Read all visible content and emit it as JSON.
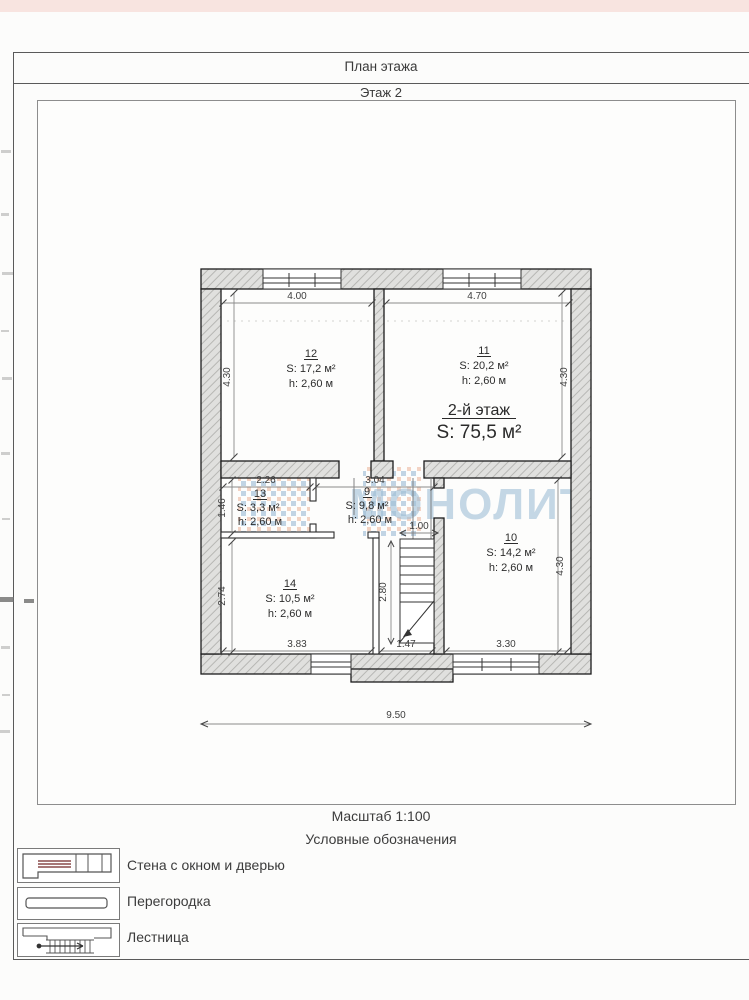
{
  "header": {
    "title": "План этажа",
    "subtitle": "Этаж 2"
  },
  "plan": {
    "watermark": "МОНОЛИТ",
    "floor_label": "2-й этаж",
    "floor_area": "S: 75,5 м²",
    "rooms": {
      "r12": {
        "number": "12",
        "area": "S: 17,2 м²",
        "height": "h: 2,60 м"
      },
      "r11": {
        "number": "11",
        "area": "S: 20,2 м²",
        "height": "h: 2,60 м"
      },
      "r13": {
        "number": "13",
        "area": "S: 3,3 м²",
        "height": "h: 2,60 м"
      },
      "r9": {
        "number": "9",
        "area": "S: 9,8 м²",
        "height": "h: 2,60 м"
      },
      "r10": {
        "number": "10",
        "area": "S: 14,2 м²",
        "height": "h: 2,60 м"
      },
      "r14": {
        "number": "14",
        "area": "S: 10,5 м²",
        "height": "h: 2,60 м"
      }
    },
    "dims": {
      "top_left": "4.00",
      "top_right": "4.70",
      "left_upper": "4.30",
      "right_upper": "4.30",
      "room13_w": "2.26",
      "hall_w": "3.04",
      "room13_h": "1.46",
      "room14_h": "2.74",
      "stair_w": "1.00",
      "stair_l": "2.80",
      "right_lower": "4.30",
      "bottom_left": "3.83",
      "bottom_mid": "1.47",
      "bottom_right": "3.30",
      "overall_w": "9.50"
    }
  },
  "footer": {
    "scale": "Масштаб 1:100",
    "legend_title": "Условные обозначения",
    "legend": [
      {
        "label": "Стена с окном и дверью"
      },
      {
        "label": "Перегородка"
      },
      {
        "label": "Лестница"
      }
    ]
  },
  "colors": {
    "watermark_blue": "#9fbfd6",
    "logo_blue": "#6f9cc4",
    "logo_orange": "#e59a77",
    "window_stripe": "#8a4a4a",
    "scan_strip_pink": "#f8e4e0",
    "wall_fill": "#e0e0de"
  }
}
